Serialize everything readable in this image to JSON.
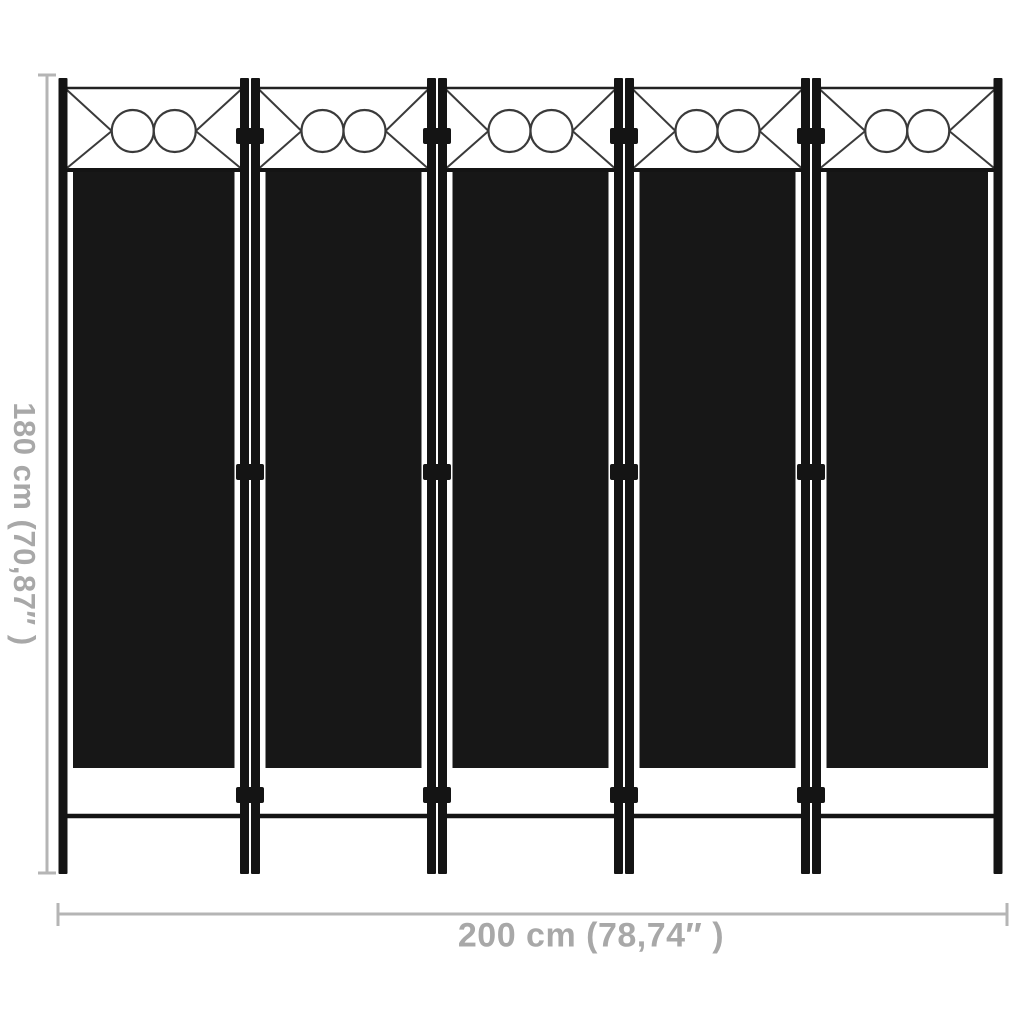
{
  "figure": {
    "type": "product-dimension-diagram",
    "subject": "room divider screen",
    "panel_count": 5,
    "circles_per_panel": 2,
    "panel_color_name": "black"
  },
  "dimensions": {
    "height_label": "180 cm (70,87″ )",
    "width_label": "200 cm (78,74″ )"
  },
  "colors": {
    "background": "#ffffff",
    "fabric": "#171717",
    "frame": "#141414",
    "ornament_stroke": "#3a3a3a",
    "dimension_line": "#b5b5b5",
    "dimension_text": "#a8a8a8"
  }
}
